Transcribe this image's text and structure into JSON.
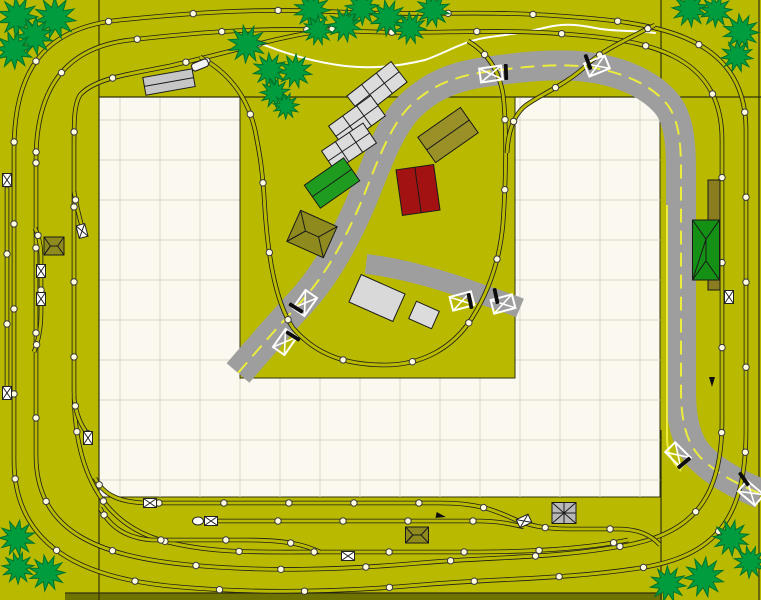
{
  "app": {
    "name": "track-plan-canvas",
    "description": "model railroad layout plan"
  },
  "canvas": {
    "width": 761,
    "height": 600
  },
  "colors": {
    "baseboard": "#b9ba00",
    "baseboard_dark_strip": "#6e7200",
    "board_white": "#faf8ef",
    "grid_line": "#d9d8c6",
    "section_line": "#33330a",
    "track": "#1b1b1b",
    "joint_dot_fill": "#fffce0",
    "joint_dot_stroke": "#3c3c3c",
    "road": "#9e9e9e",
    "road_center_line": "#ecec3c",
    "stream": "#ffffff",
    "tree_fill": "#009c3e",
    "tree_stroke": "#00722c",
    "crossing_box": "#ffffff",
    "gate_bar": "#0d0d0d",
    "marker_fill": "#ffffff",
    "marker_stroke": "#222222"
  },
  "board": {
    "grid_spacing": 40,
    "white_region": {
      "x": 99,
      "y": 97,
      "w": 561,
      "h": 400
    },
    "peninsula": {
      "x": 240,
      "y": 97,
      "w": 275,
      "h": 281
    },
    "dark_strip": {
      "x": 65,
      "y": 593,
      "w": 597,
      "h": 7
    },
    "section_lines": [
      [
        99,
        0,
        99,
        600
      ],
      [
        661,
        0,
        661,
        97
      ],
      [
        661,
        430,
        661,
        600
      ],
      [
        99,
        97,
        761,
        97
      ],
      [
        759,
        0,
        759,
        600
      ],
      [
        65,
        593,
        662,
        593
      ]
    ]
  },
  "roads": {
    "main_width": 30,
    "branch_width": 20,
    "main_path": "M 238,373 C 262,345 282,322 300,303 C 325,276 345,240 362,200 C 375,168 388,130 408,108 C 428,88 450,77 485,72 C 520,67 550,64 578,66 C 615,69 648,82 666,103 C 678,117 681,140 681,170 L 681,390 C 681,420 686,442 700,457 C 716,473 735,483 761,494",
    "branch_path": "M 366,264 C 400,268 440,279 478,293 C 495,299 508,303 520,308",
    "center_line_dash": [
      14,
      8
    ],
    "edge_line_path": "M 667,205 L 667,438 C 667,452 672,462 681,471"
  },
  "stream": {
    "path": "M 252,40 C 280,52 312,62 345,66 C 372,69 400,66 425,60 C 448,52 465,40 490,37 C 512,34 528,32 548,27 C 566,23 580,25 595,28 C 615,32 635,30 655,33"
  },
  "track": {
    "rail_outer_width": 4.6,
    "rail_inner_width": 3.0,
    "paths": [
      {
        "id": "outer-main-loop",
        "spacing": 85,
        "d": "M 14,150 C 14,75 40,28 120,20 C 200,12 260,8 340,12 C 420,16 480,10 560,16 C 650,22 746,32 746,130 L 746,430 C 746,520 715,556 640,568 C 560,580 500,578 420,585 C 340,592 260,594 180,587 C 80,579 14,545 14,460 Z"
      },
      {
        "id": "inner-main-loop",
        "spacing": 85,
        "d": "M 36,160 C 36,95 60,48 130,40 C 210,31 270,27 350,31 C 430,35 490,28 565,34 C 645,40 722,52 722,140 L 722,420 C 722,495 696,532 628,545 C 552,559 500,556 420,563 C 340,570 265,572 190,565 C 95,556 36,530 36,455 Z"
      },
      {
        "id": "third-loop-west",
        "spacing": 75,
        "d": "M 340,28 C 310,32 280,38 250,46 C 220,54 195,60 170,66 C 130,74 95,78 80,95 C 74,105 74,120 74,150 L 74,390 C 74,460 95,520 160,540 C 210,554 260,552 320,552 L 470,552 C 540,552 590,548 628,540"
      },
      {
        "id": "village-branch",
        "spacing": 70,
        "d": "M 200,57 C 228,72 247,95 255,130 C 261,160 262,170 264,195 C 267,250 274,300 293,328 C 317,356 348,365 385,365 C 422,365 453,348 472,318 C 489,291 500,259 503,223 C 506,181 507,126 503,94 C 499,71 488,53 468,41"
      },
      {
        "id": "branch-link-northeast",
        "spacing": 55,
        "d": "M 655,25 C 625,40 602,51 588,64 C 566,85 541,94 525,106 C 513,116 508,133 507,153"
      },
      {
        "id": "west-siding-long",
        "spacing": 70,
        "d": "M 7,176 L 7,392"
      },
      {
        "id": "west-siding-short",
        "spacing": 55,
        "d": "M 35,228 C 40,238 41,248 41,258 L 41,312 C 41,330 38,342 34,352"
      },
      {
        "id": "west-spur",
        "spacing": 50,
        "d": "M 74,192 C 77,208 80,220 83,230"
      },
      {
        "id": "west-stub",
        "spacing": 50,
        "d": "M 74,398 C 76,414 81,426 88,434"
      },
      {
        "id": "yard-siding-1",
        "spacing": 65,
        "d": "M 95,478 C 103,494 118,503 150,503 L 440,503 C 478,503 494,510 514,519 C 530,526 546,529 570,529 L 618,529 C 640,529 652,536 660,545"
      },
      {
        "id": "yard-siding-2",
        "spacing": 65,
        "d": "M 205,521 L 478,521 C 498,521 511,524 524,527"
      },
      {
        "id": "yard-siding-3",
        "spacing": 65,
        "d": "M 100,508 C 110,527 126,538 152,540 L 245,540 C 288,540 305,545 320,552"
      }
    ],
    "joint_dot_radius": 3.2
  },
  "buildings": [
    {
      "id": "platform-top-left",
      "cx": 169,
      "cy": 82,
      "w": 50,
      "h": 18,
      "rot": -10,
      "fill": "#c6c6c6",
      "roof": "platform"
    },
    {
      "id": "rail-vehicle",
      "cx": 200,
      "cy": 65,
      "w": 17,
      "h": 8,
      "rot": -22,
      "fill": "#f2f2f2",
      "roof": "plain"
    },
    {
      "id": "shed-row-a",
      "cx": 377,
      "cy": 89,
      "w": 56,
      "h": 26,
      "rot": -38,
      "fill": "#dcdcdc",
      "roof": "gable3"
    },
    {
      "id": "shed-row-b",
      "cx": 357,
      "cy": 121,
      "w": 52,
      "h": 25,
      "rot": -36,
      "fill": "#dcdcdc",
      "roof": "gable3"
    },
    {
      "id": "shed-row-c",
      "cx": 349,
      "cy": 147,
      "w": 50,
      "h": 24,
      "rot": -34,
      "fill": "#dcdcdc",
      "roof": "gable3"
    },
    {
      "id": "green-shed",
      "cx": 332,
      "cy": 183,
      "w": 48,
      "h": 28,
      "rot": -35,
      "fill": "#1f9b1f",
      "roof": "gable"
    },
    {
      "id": "olive-barn",
      "cx": 448,
      "cy": 135,
      "w": 52,
      "h": 31,
      "rot": -35,
      "fill": "#9a9028",
      "roof": "gable"
    },
    {
      "id": "red-house",
      "cx": 418,
      "cy": 190,
      "w": 38,
      "h": 46,
      "rot": -8,
      "fill": "#a31212",
      "roof": "gable"
    },
    {
      "id": "hip-pavilion",
      "cx": 312,
      "cy": 234,
      "w": 40,
      "h": 34,
      "rot": 24,
      "fill": "#8f8a1e",
      "roof": "hip"
    },
    {
      "id": "white-shed-large",
      "cx": 377,
      "cy": 298,
      "w": 48,
      "h": 30,
      "rot": 24,
      "fill": "#d9d9d9",
      "roof": "plain"
    },
    {
      "id": "white-shed-small",
      "cx": 424,
      "cy": 315,
      "w": 25,
      "h": 19,
      "rot": 24,
      "fill": "#dcdcdc",
      "roof": "plain"
    },
    {
      "id": "station-platform-right",
      "cx": 714,
      "cy": 235,
      "w": 12,
      "h": 110,
      "rot": 0,
      "fill": "#8a7d1f",
      "roof": "plain"
    },
    {
      "id": "green-station",
      "cx": 706,
      "cy": 250,
      "w": 27,
      "h": 60,
      "rot": 0,
      "fill": "#149114",
      "roof": "hip"
    },
    {
      "id": "yard-shed",
      "cx": 417,
      "cy": 535,
      "w": 23,
      "h": 16,
      "rot": 0,
      "fill": "#8f8a1e",
      "roof": "hip"
    },
    {
      "id": "left-pavilion",
      "cx": 54,
      "cy": 246,
      "w": 20,
      "h": 18,
      "rot": 0,
      "fill": "#8f8a1e",
      "roof": "hip"
    },
    {
      "id": "turntable",
      "cx": 564,
      "cy": 513,
      "w": 24,
      "h": 21,
      "rot": 0,
      "fill": "#b8b8b8",
      "roof": "cross"
    }
  ],
  "markers": {
    "crossing_boxes": [
      [
        491,
        74,
        -8
      ],
      [
        597,
        66,
        -22
      ],
      [
        678,
        455,
        45
      ],
      [
        751,
        493,
        40
      ],
      [
        305,
        303,
        -55
      ],
      [
        285,
        342,
        -55
      ],
      [
        462,
        301,
        -15
      ],
      [
        503,
        304,
        -15
      ]
    ],
    "crossing_gates": [
      [
        506,
        72,
        88
      ],
      [
        588,
        62,
        70
      ],
      [
        684,
        463,
        -40
      ],
      [
        744,
        479,
        55
      ],
      [
        296,
        308,
        32
      ],
      [
        293,
        336,
        32
      ],
      [
        470,
        301,
        78
      ],
      [
        496,
        296,
        78
      ]
    ],
    "uncouplers": [
      [
        7,
        180,
        90
      ],
      [
        7,
        393,
        90
      ],
      [
        41,
        271,
        90
      ],
      [
        41,
        299,
        90
      ],
      [
        82,
        231,
        75
      ],
      [
        88,
        438,
        90
      ],
      [
        150,
        503,
        0
      ],
      [
        211,
        521,
        0
      ],
      [
        348,
        556,
        0
      ],
      [
        524,
        521,
        -25
      ],
      [
        729,
        297,
        90
      ]
    ],
    "bumpers": [
      [
        198,
        521,
        0
      ]
    ],
    "signals": [
      [
        441,
        516,
        12
      ],
      [
        712,
        382,
        90
      ]
    ]
  },
  "trees": [
    [
      18,
      17,
      20
    ],
    [
      55,
      18,
      21
    ],
    [
      34,
      36,
      19
    ],
    [
      14,
      50,
      19
    ],
    [
      247,
      44,
      19
    ],
    [
      270,
      70,
      17
    ],
    [
      295,
      71,
      17
    ],
    [
      275,
      93,
      15
    ],
    [
      286,
      106,
      13
    ],
    [
      312,
      10,
      18
    ],
    [
      318,
      30,
      15
    ],
    [
      345,
      25,
      17
    ],
    [
      362,
      8,
      17
    ],
    [
      388,
      18,
      18
    ],
    [
      410,
      28,
      16
    ],
    [
      433,
      10,
      17
    ],
    [
      690,
      9,
      18
    ],
    [
      716,
      11,
      16
    ],
    [
      741,
      32,
      18
    ],
    [
      737,
      56,
      16
    ],
    [
      17,
      538,
      18
    ],
    [
      18,
      568,
      16
    ],
    [
      47,
      573,
      18
    ],
    [
      668,
      584,
      18
    ],
    [
      704,
      577,
      20
    ],
    [
      731,
      538,
      18
    ],
    [
      750,
      562,
      16
    ]
  ]
}
